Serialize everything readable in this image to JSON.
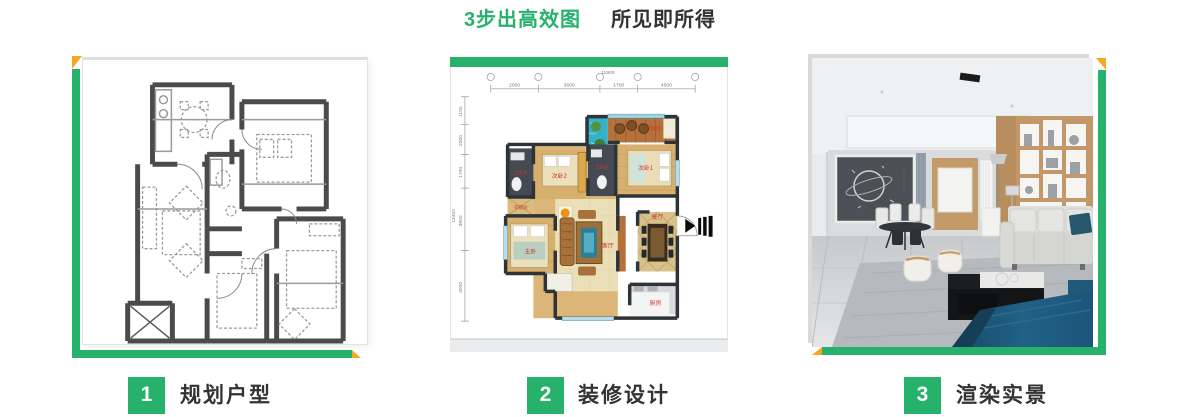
{
  "title": {
    "green_part": "3步出高效图",
    "dark_part": "所见即所得"
  },
  "steps": [
    {
      "number": "1",
      "label": "规划户型"
    },
    {
      "number": "2",
      "label": "装修设计"
    },
    {
      "number": "3",
      "label": "渲染实景"
    }
  ],
  "colors": {
    "green": "#27b26c",
    "yellow": "#f7a823",
    "label_text": "#333333",
    "room_label_red": "#cf3b28"
  },
  "floorplan_color": {
    "total_width": "11900",
    "dims_top": [
      "2000",
      "3600",
      "1700",
      "4500"
    ],
    "dims_left": [
      "1100",
      "2300",
      "1700",
      "3600",
      "3000"
    ],
    "total_height": "12400",
    "rooms": {
      "balcony": "阳台",
      "bedroom1": "次卧1",
      "bedroom2": "次卧2",
      "bath1": "卫生间",
      "bath2": "卫生间",
      "closet": "衣帽间",
      "master": "主卧",
      "living": "客厅",
      "dining": "餐厅",
      "kitchen": "厨房"
    }
  }
}
